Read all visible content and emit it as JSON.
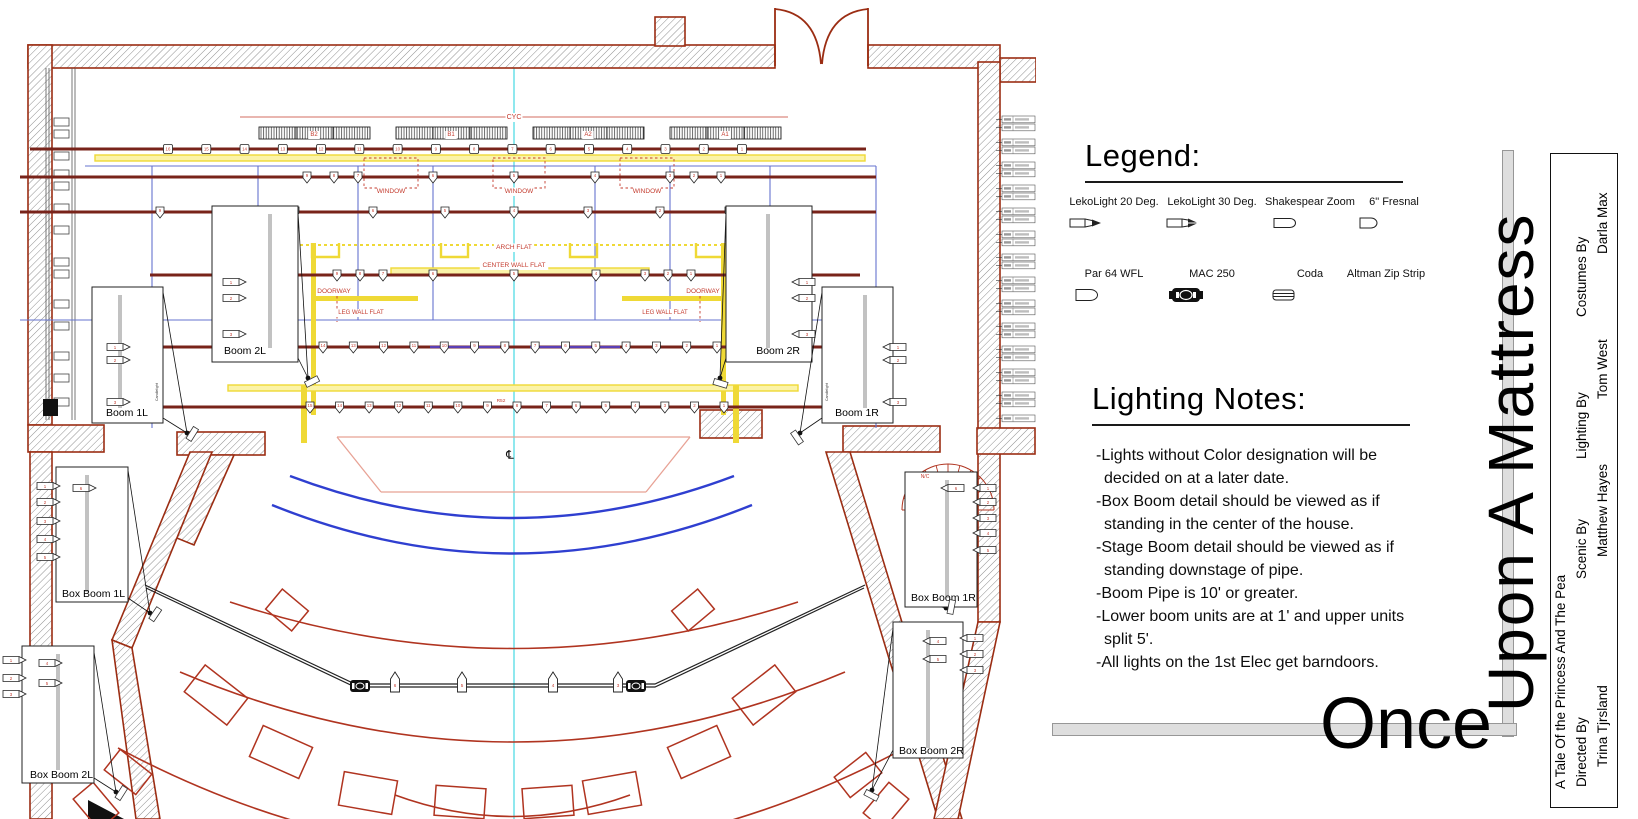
{
  "legend": {
    "heading": "Legend:",
    "items": [
      {
        "label": "LekoLight 20 Deg.",
        "icon": "leko20-icon"
      },
      {
        "label": "LekoLight 30 Deg.",
        "icon": "leko30-icon"
      },
      {
        "label": "Shakespear Zoom",
        "icon": "shakespeare-icon"
      },
      {
        "label": "6\" Fresnal",
        "icon": "fresnel-icon"
      },
      {
        "label": "Par 64 WFL",
        "icon": "par64-icon"
      },
      {
        "label": "MAC 250",
        "icon": "mac250-icon"
      },
      {
        "label": "Coda",
        "icon": "coda-icon"
      },
      {
        "label": "Altman Zip Strip",
        "icon": "zipstrip-icon"
      }
    ]
  },
  "lighting_notes": {
    "heading": "Lighting Notes:",
    "notes": [
      "-Lights without Color designation will be decided on at a later date.",
      "-Box Boom detail should be viewed as if standing in the center of the house.",
      "-Stage Boom detail should be viewed as if standing downstage of pipe.",
      "-Boom Pipe is 10' or greater.",
      "-Lower boom units are at 1' and upper units split 5'.",
      "-All lights on the 1st Elec get barndoors."
    ]
  },
  "titles": {
    "once": "Once",
    "upon": "Upon A Mattress"
  },
  "title_block": {
    "subtitle": "A Tale Of the Princess And The Pea",
    "credits": [
      {
        "role": "Directed By",
        "name": "Trina Tjrsland"
      },
      {
        "role": "Scenic By",
        "name": "Matthew Hayes"
      },
      {
        "role": "Lighting By",
        "name": "Tom West"
      },
      {
        "role": "Costumes By",
        "name": "Darla Max"
      }
    ]
  },
  "plot": {
    "center_line_symbol": "℄",
    "labels": {
      "cyc": "CYC",
      "window": "WINDOW",
      "arch_flat": "ARCH FLAT",
      "center_wall_flat": "CENTER WALL FLAT",
      "doorway": "DOORWAY",
      "leg_wall_flat": "LEG WALL FLAT",
      "color_call": "R52",
      "no_color": "N/C",
      "gel_note": "Candlelight"
    },
    "cyc_strips": [
      "B2",
      "B1",
      "A2",
      "A1"
    ],
    "electrics": [
      {
        "units": [
          "16",
          "15",
          "14",
          "13",
          "12",
          "11",
          "10",
          "9",
          "8",
          "7",
          "6",
          "5",
          "4",
          "3",
          "2",
          "1"
        ]
      },
      {
        "units": [
          "9",
          "8",
          "7",
          "6",
          "5",
          "4",
          "3",
          "2",
          "1"
        ]
      },
      {
        "units": [
          "9",
          "8",
          "7",
          "6",
          "5",
          "4",
          "3",
          "2",
          "1"
        ]
      },
      {
        "units": [
          "9",
          "8",
          "7",
          "6",
          "5",
          "4",
          "3",
          "2",
          "1"
        ]
      },
      {
        "units": [
          "14",
          "13",
          "12",
          "11",
          "10",
          "9",
          "8",
          "7",
          "6",
          "5",
          "4",
          "3",
          "2",
          "1"
        ]
      },
      {
        "units": [
          "15",
          "14",
          "13",
          "12",
          "11",
          "10",
          "9",
          "8",
          "7",
          "6",
          "5",
          "4",
          "3",
          "2",
          "1"
        ]
      }
    ],
    "foh_rail": {
      "units": [
        "6",
        "5",
        "4",
        "3"
      ],
      "moving_lights": 2
    },
    "booms": [
      {
        "label": "Boom 2L",
        "units": [
          "1",
          "2",
          "3"
        ]
      },
      {
        "label": "Boom 2R",
        "units": [
          "1",
          "2",
          "3"
        ]
      },
      {
        "label": "Boom 1L",
        "units": [
          "1",
          "2",
          "3"
        ]
      },
      {
        "label": "Boom 1R",
        "units": [
          "1",
          "2",
          "3"
        ]
      },
      {
        "label": "Box Boom 1L",
        "units": [
          "1",
          "2",
          "3",
          "4",
          "5",
          "6"
        ]
      },
      {
        "label": "Box Boom 1R",
        "units": [
          "1",
          "2",
          "3",
          "4",
          "5",
          "6"
        ]
      },
      {
        "label": "Box Boom 2L",
        "units": [
          "1",
          "2",
          "3",
          "4",
          "5"
        ]
      },
      {
        "label": "Box Boom 2R",
        "units": [
          "1",
          "2",
          "3",
          "4",
          "5"
        ]
      }
    ]
  },
  "colors": {
    "wall_outline": "#9B2D13",
    "pipe": "#78231A",
    "annotation_red": "#C43B2E",
    "scenery_yellow": "#EFD936",
    "portal_blue": "#6673CF",
    "house_arc_blue": "#2F3FD0",
    "seating_red": "#B03420",
    "center_line_cyan": "#8FE8EE",
    "apron_salmon": "#E8A295"
  }
}
